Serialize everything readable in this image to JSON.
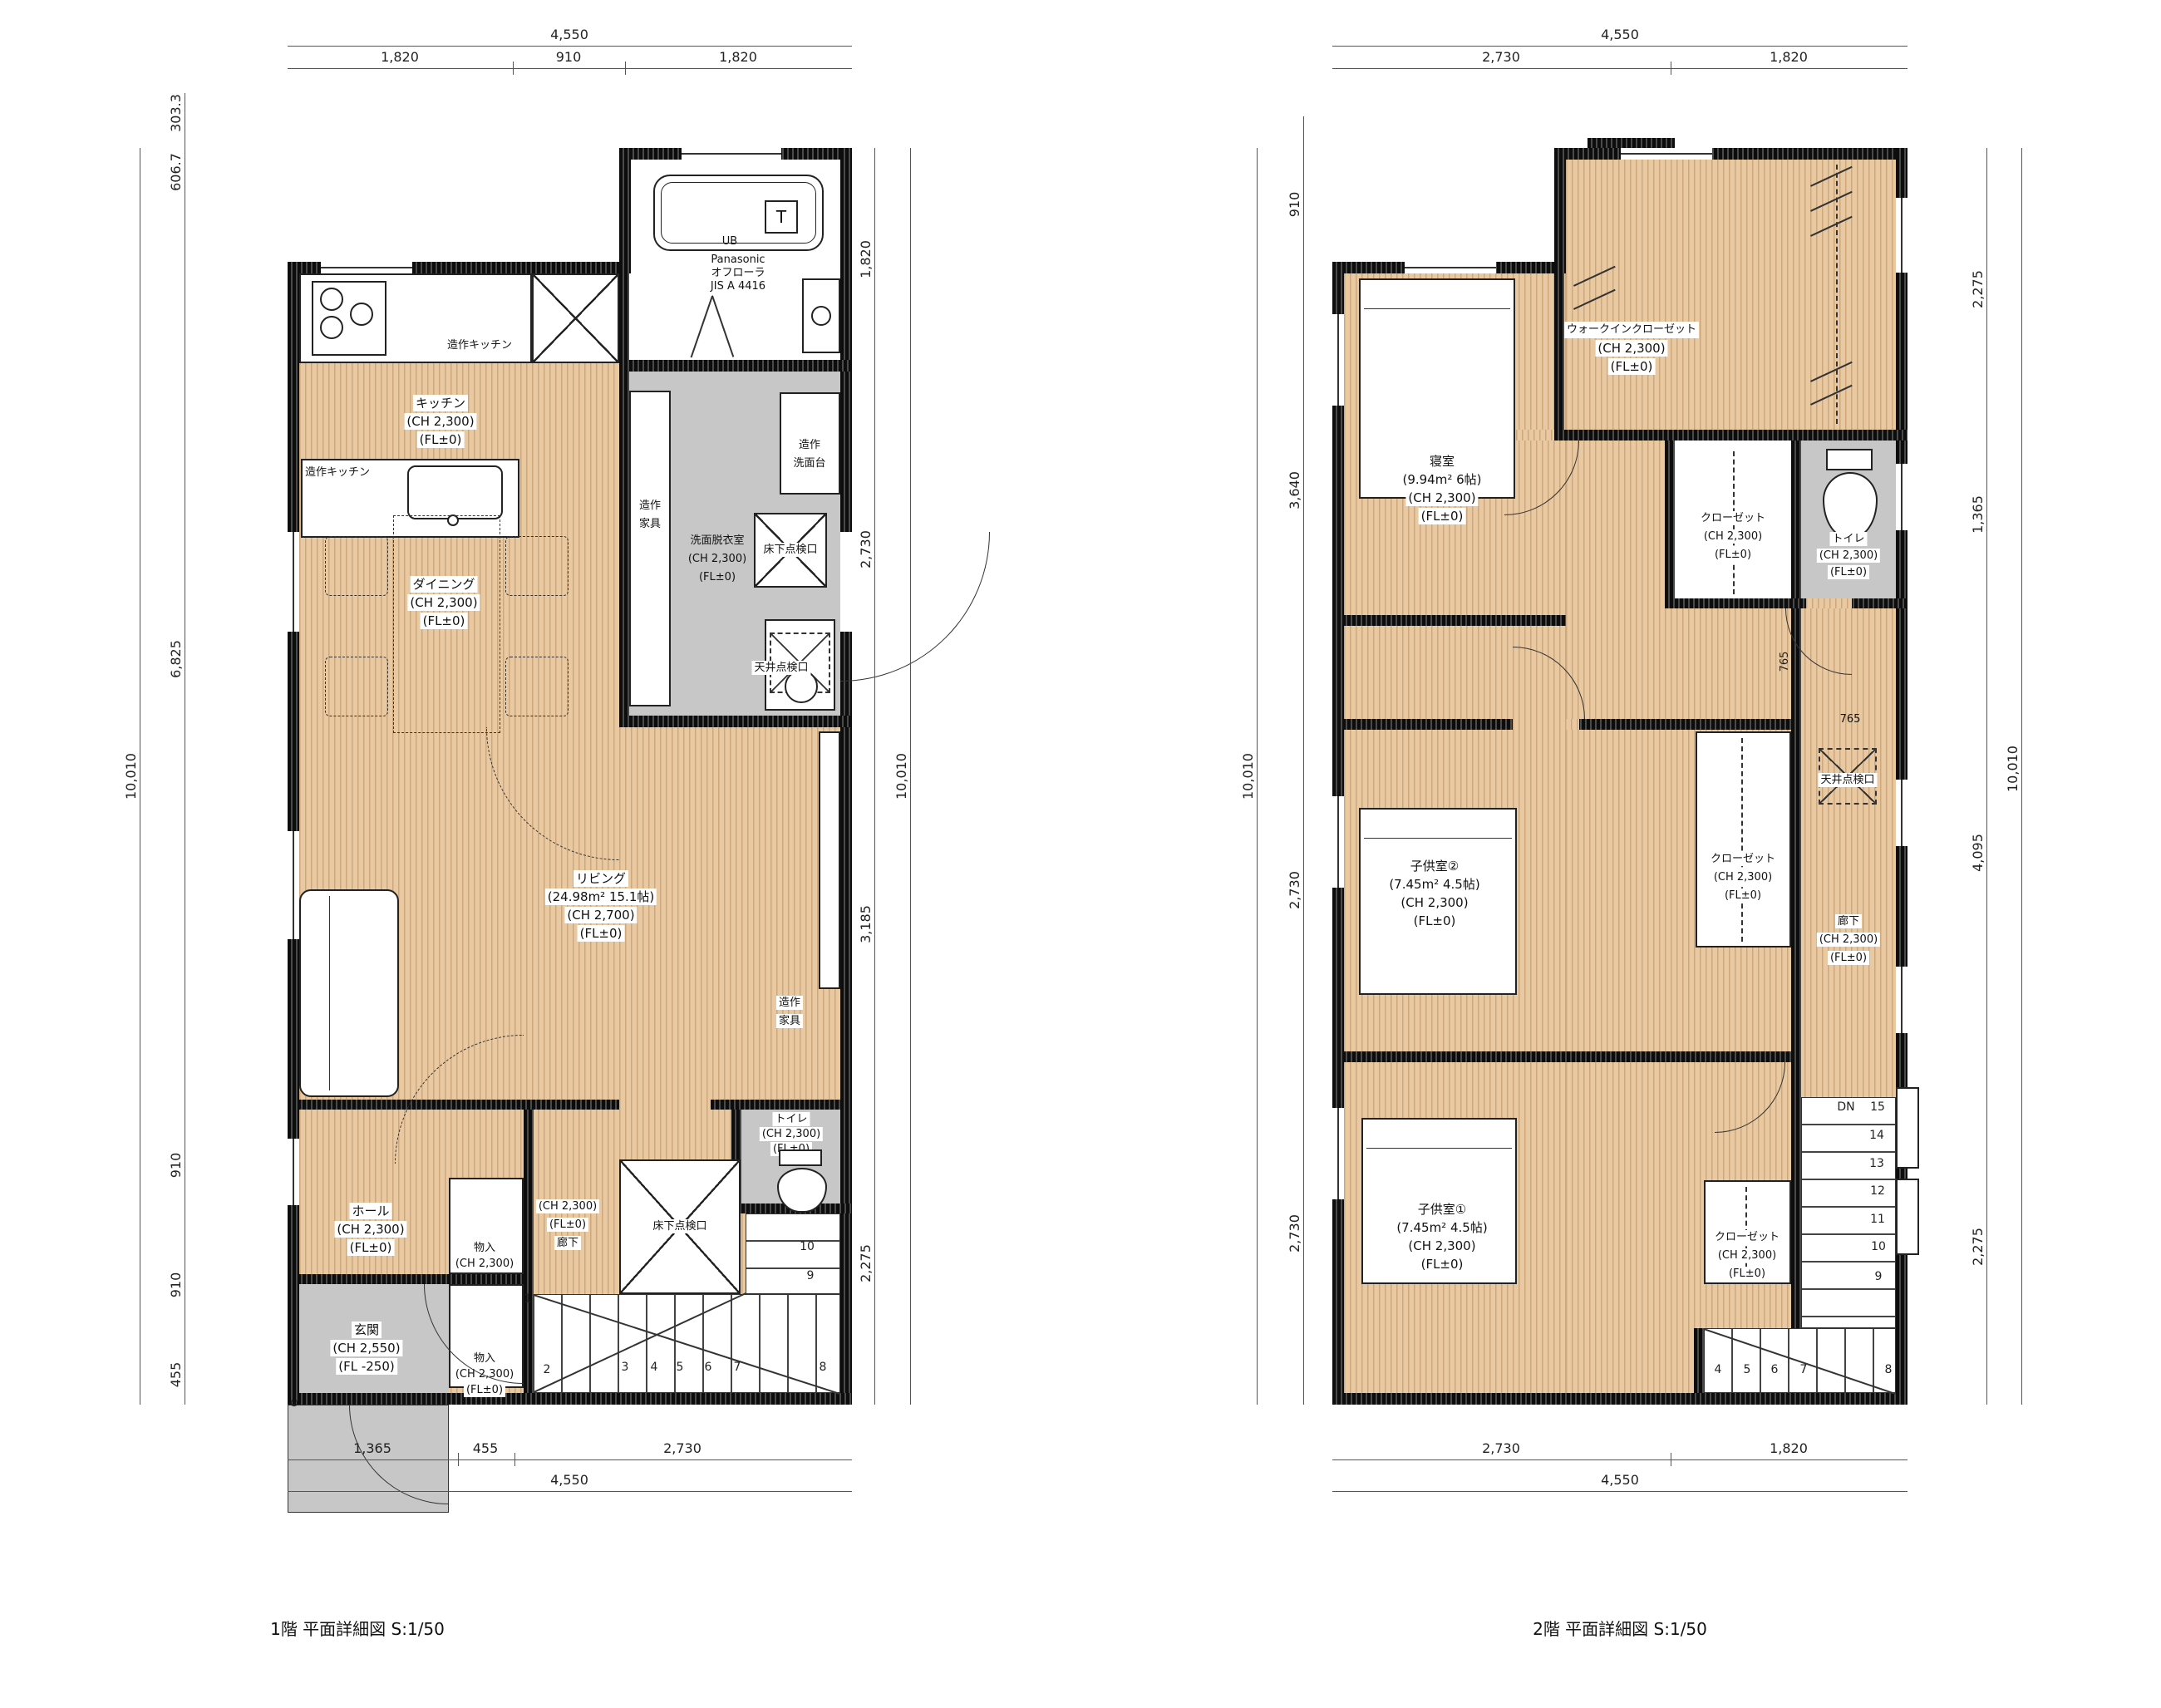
{
  "captions": {
    "floor1": "1階 平面詳細図  S:1/50",
    "floor2": "2階 平面詳細図  S:1/50"
  },
  "shared": {
    "floor_access": "床下点検口",
    "ceiling_access": "天井点検口",
    "custom_kitchen": "造作キッチン",
    "dn": "DN",
    "mark": "⊗"
  },
  "colors": {
    "wood": "#e9c9a2",
    "gray": "#c7c7c7",
    "wall": "#141414"
  },
  "floor1": {
    "dims": {
      "top": {
        "total": "4,550",
        "segs": [
          "1,820",
          "910",
          "1,820"
        ]
      },
      "left": {
        "total": "10,010",
        "segs": [
          "303.3",
          "606.7",
          "6,825",
          "910",
          "910",
          "455"
        ]
      },
      "right": {
        "total": "10,010",
        "segs": [
          "1,820",
          "2,730",
          "3,185",
          "2,275"
        ]
      },
      "bottom": {
        "total": "4,550",
        "segs": [
          "1,365",
          "455",
          "2,730"
        ]
      }
    },
    "bath": {
      "brand": "Panasonic",
      "model": "オフローラ",
      "standard": "JIS A 4416",
      "unit": "UB",
      "t": "T"
    },
    "kitchen": [
      "キッチン",
      "(CH 2,300)",
      "(FL±0)"
    ],
    "washroom": [
      "洗面脱衣室",
      "(CH 2,300)",
      "(FL±0)"
    ],
    "vanity_label": [
      "造作",
      "洗面台"
    ],
    "furniture_label": [
      "造作",
      "家具"
    ],
    "dining": [
      "ダイニング",
      "(CH 2,300)",
      "(FL±0)"
    ],
    "living": [
      "リビング",
      "(24.98m² 15.1帖)",
      "(CH 2,700)",
      "(FL±0)"
    ],
    "toilet": [
      "トイレ",
      "(CH 2,300)",
      "(FL±0)"
    ],
    "corridor": [
      "(CH 2,300)",
      "(FL±0)",
      "廊下"
    ],
    "hall": [
      "ホール",
      "(CH 2,300)",
      "(FL±0)"
    ],
    "storage1": [
      "物入",
      "(CH 2,300)"
    ],
    "entrance": [
      "玄関",
      "(CH 2,550)",
      "(FL -250)"
    ],
    "storage2": [
      "物入",
      "(CH 2,300)",
      "(FL±0)"
    ],
    "stairs": [
      "1",
      "2",
      "3",
      "4",
      "5",
      "6",
      "7",
      "8",
      "9",
      "10"
    ]
  },
  "floor2": {
    "dims": {
      "top": {
        "total": "4,550",
        "segs": [
          "2,730",
          "1,820"
        ]
      },
      "left": {
        "total": "10,010",
        "segs": [
          "910",
          "3,640",
          "2,730",
          "2,730"
        ]
      },
      "right": {
        "total": "10,010",
        "segs": [
          "2,275",
          "1,365",
          "4,095",
          "2,275"
        ]
      },
      "bottom": {
        "total": "4,550",
        "segs": [
          "2,730",
          "1,820"
        ]
      },
      "doors": [
        "765",
        "765"
      ]
    },
    "bedroom": [
      "寝室",
      "(9.94m² 6帖)",
      "(CH 2,300)",
      "(FL±0)"
    ],
    "wic": [
      "ウォークインクローゼット",
      "(CH 2,300)",
      "(FL±0)"
    ],
    "closet": [
      "クローゼット",
      "(CH 2,300)",
      "(FL±0)"
    ],
    "toilet": [
      "トイレ",
      "(CH 2,300)",
      "(FL±0)"
    ],
    "child2": [
      "子供室②",
      "(7.45m² 4.5帖)",
      "(CH 2,300)",
      "(FL±0)"
    ],
    "child1": [
      "子供室①",
      "(7.45m² 4.5帖)",
      "(CH 2,300)",
      "(FL±0)"
    ],
    "corridor": [
      "廊下",
      "(CH 2,300)",
      "(FL±0)"
    ],
    "stairs_up": [
      "15",
      "14",
      "13",
      "12",
      "11",
      "10",
      "9"
    ],
    "stairs_bottom": [
      "4",
      "5",
      "6",
      "7",
      "8"
    ]
  }
}
